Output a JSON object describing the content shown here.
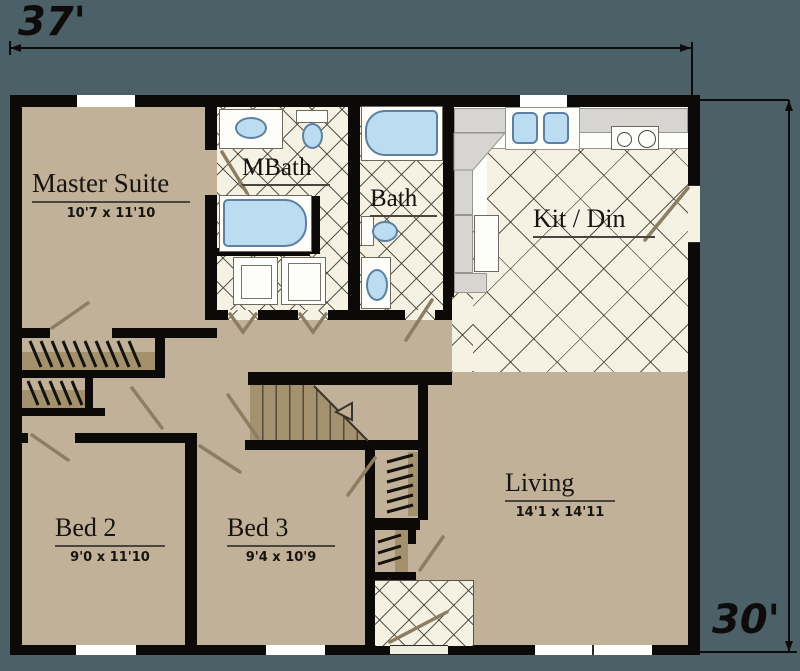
{
  "title": "Two-story home second floor plan",
  "dimension_labels": {
    "width": "37'",
    "height": "30'"
  },
  "rooms": {
    "master": {
      "name": "Master Suite",
      "dims": "10'7 x 11'10"
    },
    "mbath": {
      "name": "MBath"
    },
    "bath": {
      "name": "Bath"
    },
    "kitdin": {
      "name": "Kit / Din"
    },
    "living": {
      "name": "Living",
      "dims": "14'1 x 14'11"
    },
    "bed2": {
      "name": "Bed 2",
      "dims": "9'0 x 11'10"
    },
    "bed3": {
      "name": "Bed 3",
      "dims": "9'4 x 10'9"
    }
  },
  "colors": {
    "background": "#4c6067",
    "wall": "#0b0a08",
    "floor_tan": "#c1b199",
    "shelf_tan": "#a3916d",
    "tile": "#f5f2e3",
    "fixture_blue": "#bcdcf2",
    "counter_gray": "#d7d5d2",
    "door_swing": "#8c7d63",
    "text": "#171310"
  }
}
